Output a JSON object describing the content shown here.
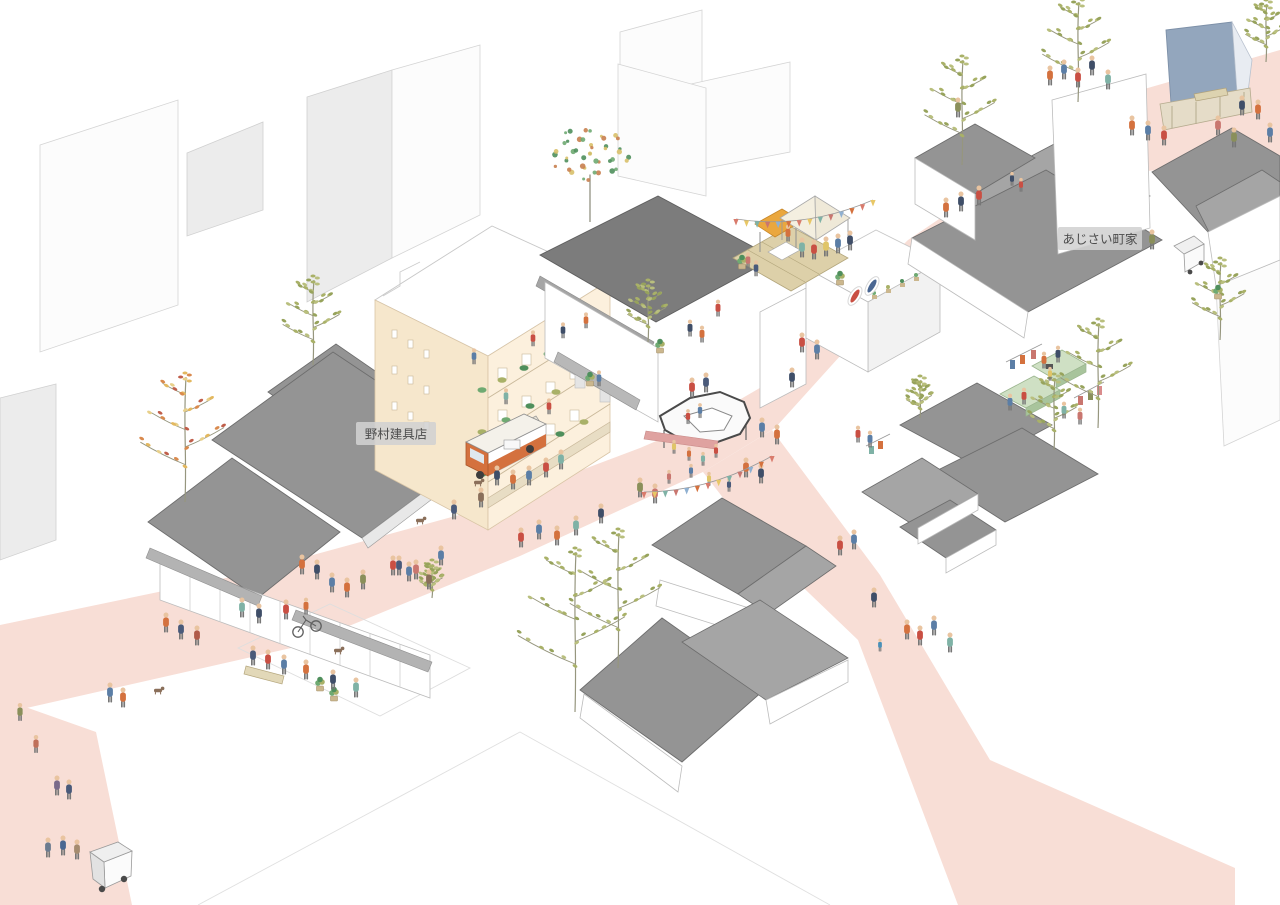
{
  "labels": {
    "shop_left": "野村建具店",
    "machiya_right": "あじさい町家",
    "building_sign": "BLDG"
  },
  "palette": {
    "street": "#f8ded6",
    "roof": "#949494",
    "roofDark": "#7c7c7c",
    "roofLight": "#a5a5a5",
    "roofLine": "#6d6d6d",
    "wall": "#ffffff",
    "wallLine": "#bcbcbc",
    "cream": "#fcf0dd",
    "creamShade": "#f6e7cc",
    "creamLine": "#d9c5a6",
    "blue": "#93a6bd",
    "deck": "#ddd0a9",
    "canopy": "#eaa73e",
    "platform": "#cfe0c4",
    "accentOrange": "#d4713e",
    "labelBg": "#d2d2d2",
    "labelText": "#4c4c4c",
    "skin": "#e9c4a0"
  },
  "scene": {
    "flag_colors": [
      "#d97b6c",
      "#e8c766",
      "#7fb2a6",
      "#c9766f",
      "#8fb0d1",
      "#d4713e"
    ],
    "leaf_olive": [
      "#a9b168",
      "#b9bf7e",
      "#97a35c"
    ],
    "leaf_autumn": [
      "#e3b85f",
      "#d98a4e",
      "#c05f4b",
      "#e8d08a"
    ],
    "leaf_dots": [
      "#6faa72",
      "#4f8f5c",
      "#d8c06a",
      "#c87f4f"
    ],
    "bunting": [
      [
        736,
        219,
        873,
        200,
        10,
        14
      ],
      [
        644,
        492,
        772,
        456,
        9,
        13
      ]
    ],
    "trees": [
      [
        185,
        502,
        "autumn",
        125
      ],
      [
        313,
        365,
        "olive",
        85
      ],
      [
        590,
        222,
        "dots",
        95
      ],
      [
        648,
        342,
        "olive",
        58
      ],
      [
        575,
        712,
        "olive",
        160
      ],
      [
        618,
        668,
        "olive",
        135
      ],
      [
        1098,
        428,
        "olive",
        105
      ],
      [
        1054,
        450,
        "olive",
        72
      ],
      [
        962,
        165,
        "olive",
        105
      ],
      [
        1078,
        102,
        "olive",
        100
      ],
      [
        1266,
        62,
        "olive",
        58
      ],
      [
        1220,
        340,
        "olive",
        78
      ],
      [
        920,
        418,
        "olive",
        38
      ],
      [
        432,
        598,
        "olive",
        34
      ]
    ],
    "dogs": [
      [
        478,
        484
      ],
      [
        420,
        522
      ],
      [
        158,
        692
      ],
      [
        338,
        652
      ]
    ],
    "pots": [
      [
        320,
        690
      ],
      [
        334,
        700
      ],
      [
        590,
        385
      ],
      [
        742,
        268
      ],
      [
        1218,
        298
      ],
      [
        660,
        352
      ],
      [
        840,
        284
      ]
    ],
    "people": [
      [
        48,
        852,
        "#6b7b8f"
      ],
      [
        63,
        850,
        "#4a6792"
      ],
      [
        77,
        854,
        "#a58c6f"
      ],
      [
        57,
        790,
        "#7a6a8a"
      ],
      [
        69,
        794,
        "#4a5a7a"
      ],
      [
        36,
        748,
        "#c0705a",
        0.9
      ],
      [
        110,
        697,
        "#5b7ea6"
      ],
      [
        123,
        702,
        "#d4713e"
      ],
      [
        20,
        716,
        "#8a8f5a",
        0.9
      ],
      [
        166,
        627,
        "#d4713e"
      ],
      [
        181,
        634,
        "#4a5a7a"
      ],
      [
        197,
        640,
        "#b05a4a"
      ],
      [
        242,
        612,
        "#7fb2a6"
      ],
      [
        259,
        618,
        "#3f4e68"
      ],
      [
        286,
        614,
        "#c94f43"
      ],
      [
        302,
        569,
        "#d4713e"
      ],
      [
        317,
        574,
        "#3f4e68"
      ],
      [
        332,
        587,
        "#5b7ea6"
      ],
      [
        347,
        592,
        "#d4713e"
      ],
      [
        363,
        584,
        "#8a8f5a"
      ],
      [
        399,
        570,
        "#4a5a7a"
      ],
      [
        416,
        574,
        "#c9766f"
      ],
      [
        441,
        560,
        "#5b7ea6"
      ],
      [
        521,
        542,
        "#c94f43"
      ],
      [
        539,
        534,
        "#5b7ea6"
      ],
      [
        557,
        540,
        "#d4713e"
      ],
      [
        576,
        530,
        "#7fb2a6"
      ],
      [
        601,
        518,
        "#3f4e68"
      ],
      [
        253,
        660,
        "#4a5a7a"
      ],
      [
        268,
        664,
        "#c94f43"
      ],
      [
        284,
        669,
        "#5b7ea6"
      ],
      [
        306,
        674,
        "#d4713e"
      ],
      [
        333,
        684,
        "#3f4e68"
      ],
      [
        356,
        692,
        "#7fb2a6"
      ],
      [
        393,
        570,
        "#c94f43"
      ],
      [
        409,
        576,
        "#5b7ea6"
      ],
      [
        429,
        584,
        "#8a6f5a"
      ],
      [
        497,
        480,
        "#3f4e68"
      ],
      [
        513,
        484,
        "#d4713e"
      ],
      [
        529,
        480,
        "#5b7ea6"
      ],
      [
        546,
        472,
        "#c94f43"
      ],
      [
        561,
        464,
        "#7fb2a6"
      ],
      [
        481,
        502,
        "#8a6f5a"
      ],
      [
        454,
        514,
        "#4a5a7a"
      ],
      [
        474,
        360,
        "#5b7ea6",
        0.8
      ],
      [
        533,
        342,
        "#c94f43",
        0.8
      ],
      [
        563,
        334,
        "#3f4e68",
        0.8
      ],
      [
        586,
        324,
        "#d4713e",
        0.8
      ],
      [
        506,
        400,
        "#7fb2a6",
        0.8
      ],
      [
        549,
        410,
        "#c94f43",
        0.8
      ],
      [
        599,
        382,
        "#5b7ea6",
        0.8
      ],
      [
        674,
        450,
        "#e0c568",
        0.7
      ],
      [
        689,
        457,
        "#d4713e",
        0.7
      ],
      [
        703,
        462,
        "#7fb2a6",
        0.7
      ],
      [
        716,
        454,
        "#c94f43",
        0.7
      ],
      [
        691,
        474,
        "#5b7ea6",
        0.7
      ],
      [
        709,
        482,
        "#e0c568",
        0.7
      ],
      [
        669,
        480,
        "#c9766f",
        0.7
      ],
      [
        729,
        488,
        "#4a5a7a",
        0.7
      ],
      [
        746,
        472,
        "#d4713e"
      ],
      [
        761,
        478,
        "#3f4e68"
      ],
      [
        688,
        420,
        "#c94f43",
        0.75
      ],
      [
        700,
        414,
        "#5b7ea6",
        0.75
      ],
      [
        692,
        392,
        "#c94f43"
      ],
      [
        706,
        387,
        "#4a5a7a"
      ],
      [
        762,
        432,
        "#5b7ea6"
      ],
      [
        777,
        439,
        "#d4713e"
      ],
      [
        802,
        347,
        "#c94f43"
      ],
      [
        817,
        354,
        "#5b7ea6"
      ],
      [
        792,
        382,
        "#3f4e68"
      ],
      [
        640,
        492,
        "#8a8f5a"
      ],
      [
        655,
        498,
        "#c9766f"
      ],
      [
        690,
        332,
        "#3f4e68",
        0.85
      ],
      [
        702,
        338,
        "#d4713e",
        0.85
      ],
      [
        718,
        312,
        "#c94f43",
        0.85
      ],
      [
        802,
        252,
        "#7fb2a6"
      ],
      [
        814,
        254,
        "#c94f43"
      ],
      [
        826,
        251,
        "#e0c568"
      ],
      [
        838,
        248,
        "#5b7ea6"
      ],
      [
        850,
        245,
        "#3f4e68"
      ],
      [
        788,
        237,
        "#d4713e",
        0.85
      ],
      [
        756,
        272,
        "#4a5a7a",
        0.8
      ],
      [
        748,
        264,
        "#c9766f",
        0.8
      ],
      [
        946,
        212,
        "#d4713e"
      ],
      [
        961,
        206,
        "#3f4e68"
      ],
      [
        979,
        200,
        "#c94f43"
      ],
      [
        1044,
        364,
        "#d4713e",
        0.85
      ],
      [
        1058,
        358,
        "#3f4e68",
        0.85
      ],
      [
        1050,
        377,
        "#e0c568",
        0.7
      ],
      [
        1024,
        400,
        "#c94f43",
        0.85
      ],
      [
        1010,
        406,
        "#5b7ea6",
        0.85
      ],
      [
        1064,
        414,
        "#7fb2a6",
        0.85
      ],
      [
        1080,
        420,
        "#c9766f",
        0.85
      ],
      [
        858,
        438,
        "#c94f43",
        0.85
      ],
      [
        870,
        443,
        "#5b7ea6",
        0.85
      ],
      [
        840,
        550,
        "#c94f43"
      ],
      [
        854,
        544,
        "#5b7ea6"
      ],
      [
        874,
        602,
        "#3f4e68"
      ],
      [
        907,
        634,
        "#d4713e"
      ],
      [
        920,
        640,
        "#c94f43"
      ],
      [
        934,
        630,
        "#5b7ea6"
      ],
      [
        950,
        647,
        "#7fb2a6"
      ],
      [
        880,
        648,
        "#4a90b8",
        0.65
      ],
      [
        1050,
        80,
        "#d4713e"
      ],
      [
        1064,
        74,
        "#5b7ea6"
      ],
      [
        1078,
        82,
        "#c94f43"
      ],
      [
        1092,
        70,
        "#3f4e68"
      ],
      [
        1108,
        84,
        "#7fb2a6"
      ],
      [
        1132,
        130,
        "#d4713e"
      ],
      [
        1148,
        135,
        "#5b7ea6"
      ],
      [
        1164,
        140,
        "#c94f43"
      ],
      [
        1242,
        110,
        "#3f4e68"
      ],
      [
        1258,
        114,
        "#d4713e"
      ],
      [
        1270,
        137,
        "#5b7ea6"
      ],
      [
        1218,
        130,
        "#c9766f"
      ],
      [
        1234,
        142,
        "#8a8f5a"
      ],
      [
        1012,
        182,
        "#3f4e68",
        0.7
      ],
      [
        1021,
        188,
        "#c94f43",
        0.7
      ],
      [
        958,
        112,
        "#8a8f5a"
      ],
      [
        1152,
        244,
        "#8a8f5a"
      ],
      [
        306,
        610,
        "#d4713e",
        0.85
      ]
    ]
  }
}
